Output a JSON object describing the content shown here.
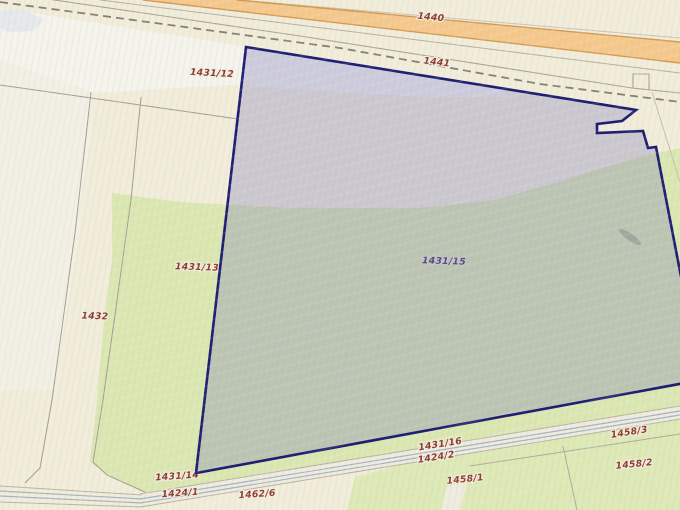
{
  "app": {
    "view": "cadastral-parcel-map"
  },
  "map": {
    "selected_parcel": {
      "id": "1431/15"
    },
    "labels": [
      {
        "text": "1440",
        "kind": "road"
      },
      {
        "text": "1441",
        "kind": "boundary-line"
      },
      {
        "text": "1431/12",
        "kind": "parcel"
      },
      {
        "text": "1431/13",
        "kind": "parcel"
      },
      {
        "text": "1432",
        "kind": "parcel"
      },
      {
        "text": "1431/15",
        "kind": "parcel-selected"
      },
      {
        "text": "1431/16",
        "kind": "parcel"
      },
      {
        "text": "1424/2",
        "kind": "parcel"
      },
      {
        "text": "1458/1",
        "kind": "parcel"
      },
      {
        "text": "1458/2",
        "kind": "parcel"
      },
      {
        "text": "1458/3",
        "kind": "parcel"
      },
      {
        "text": "1431/14",
        "kind": "parcel"
      },
      {
        "text": "1424/1",
        "kind": "parcel"
      },
      {
        "text": "1462/6",
        "kind": "parcel"
      }
    ],
    "colors": {
      "background_beige": "#f1edda",
      "pale_band": "#f4f3ee",
      "green_parcel": "#dbe7b2",
      "selected_fill_overlay": "rgba(116,116,186,0.30)",
      "selected_border": "#1d1d72",
      "road_fill": "#f5c98e",
      "road_edge": "#d49a55",
      "boundary_line": "#a39e90",
      "dashed_line": "#85806f",
      "road_casing_blue": "#a4b4c2",
      "label_color": "#8c3a32",
      "selected_label_color": "#4d3a58"
    }
  }
}
